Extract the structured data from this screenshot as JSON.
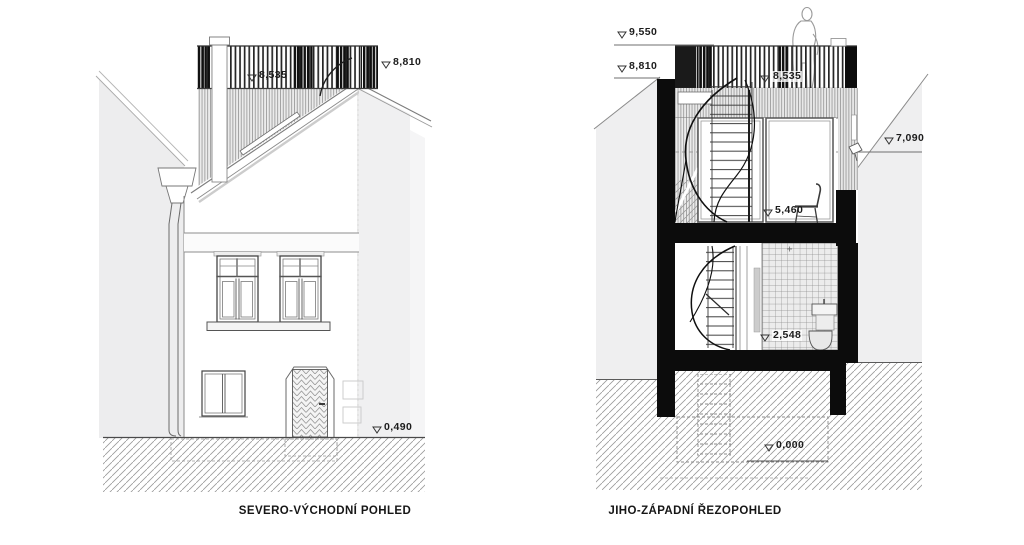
{
  "sheet": {
    "type": "architectural elevations / section sheet",
    "background": "#ffffff"
  },
  "titles": {
    "left": "SEVERO-VÝCHODNÍ POHLED",
    "right": "JIHO-ZÁPADNÍ ŘEZOPOHLED"
  },
  "levels": {
    "left": {
      "terrace": "8,535",
      "ridge": "8,810",
      "plinth": "0,490"
    },
    "right": {
      "railing_top": "9,550",
      "attic": "8,810",
      "terrace": "8,535",
      "neighbor_eave": "7,090",
      "upper_floor": "5,460",
      "ground_floor": "2,548",
      "base": "0,000"
    }
  },
  "icons": {
    "level_marker": "open-triangle-down"
  },
  "colors": {
    "line": "#555555",
    "wall_cut": "#0c0c0c",
    "neighbor_fill": "#efeff0",
    "hatch_line": "#9b9b9b",
    "stripe": "#9e9e9e",
    "text": "#1c1c1c"
  }
}
